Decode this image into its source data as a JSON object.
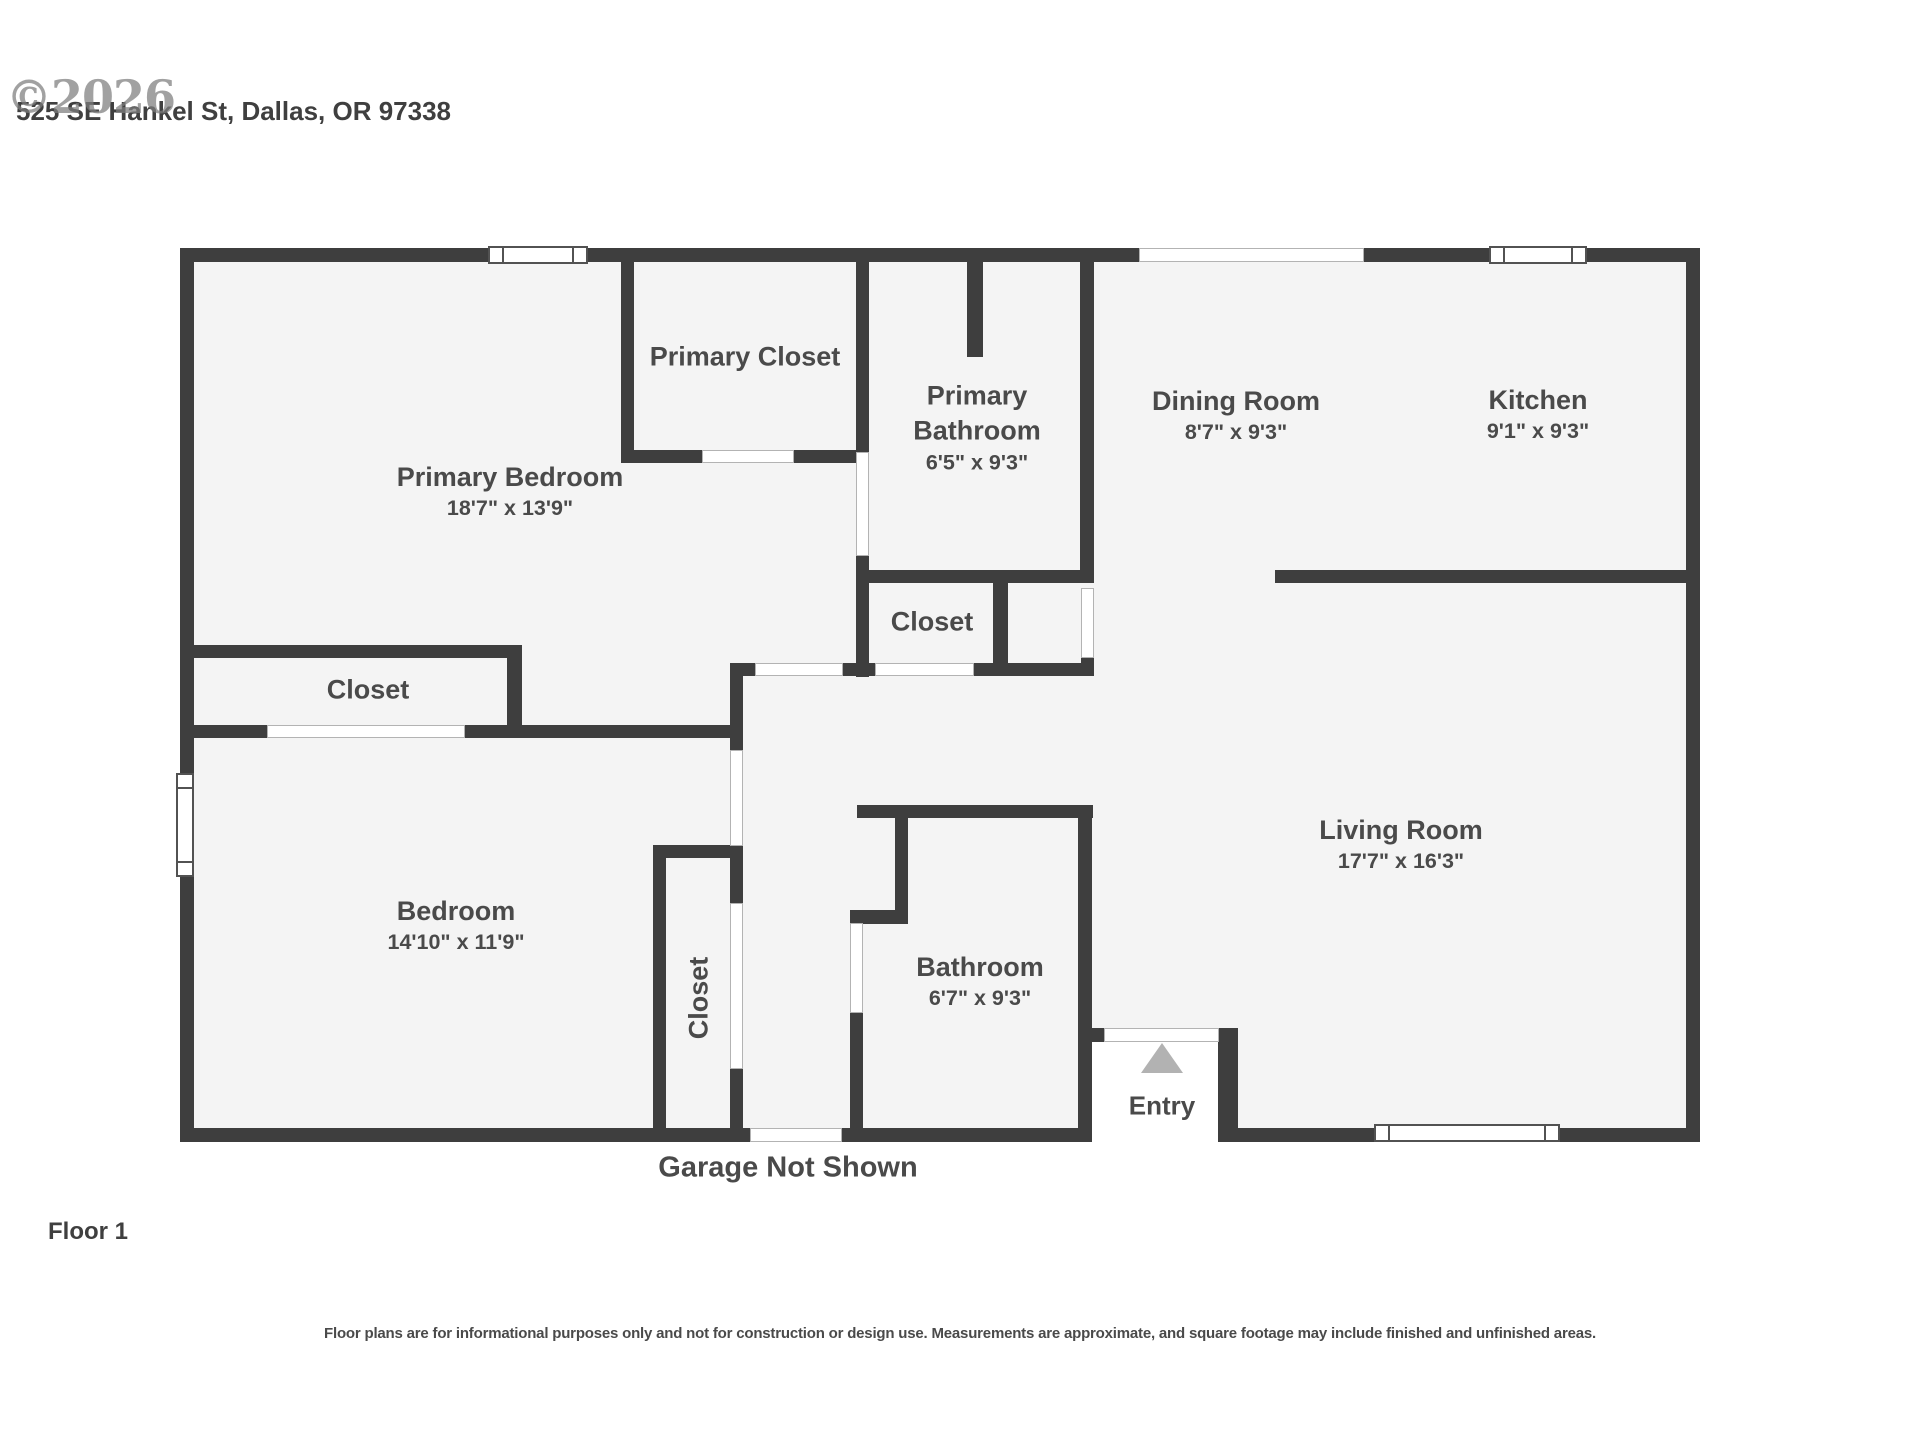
{
  "header": {
    "watermark": "©2026",
    "address": "525 SE Hankel St, Dallas, OR 97338"
  },
  "rooms": {
    "primary_bedroom": {
      "name": "Primary Bedroom",
      "dims": "18'7\" x 13'9\""
    },
    "primary_closet": {
      "name": "Primary Closet"
    },
    "primary_bathroom": {
      "name": "Primary Bathroom",
      "dims": "6'5\" x 9'3\""
    },
    "dining_room": {
      "name": "Dining Room",
      "dims": "8'7\" x 9'3\""
    },
    "kitchen": {
      "name": "Kitchen",
      "dims": "9'1\" x 9'3\""
    },
    "hall_closet": {
      "name": "Closet"
    },
    "left_closet": {
      "name": "Closet"
    },
    "living_room": {
      "name": "Living Room",
      "dims": "17'7\" x 16'3\""
    },
    "bedroom": {
      "name": "Bedroom",
      "dims": "14'10\" x 11'9\""
    },
    "vertical_closet": {
      "name": "Closet"
    },
    "bathroom": {
      "name": "Bathroom",
      "dims": "6'7\" x 9'3\""
    },
    "entry": {
      "name": "Entry"
    }
  },
  "notes": {
    "garage": "Garage Not Shown",
    "floor": "Floor 1",
    "disclaimer": "Floor plans are for informational purposes only and not for construction or design use. Measurements are approximate, and square footage may include finished and unfinished areas."
  },
  "colors": {
    "wall": "#3e3e3e",
    "floor_fill": "#f4f4f4",
    "label_text": "#4a4a4a",
    "entry_arrow": "#b2b2b2",
    "watermark": "#7e7e7e"
  }
}
